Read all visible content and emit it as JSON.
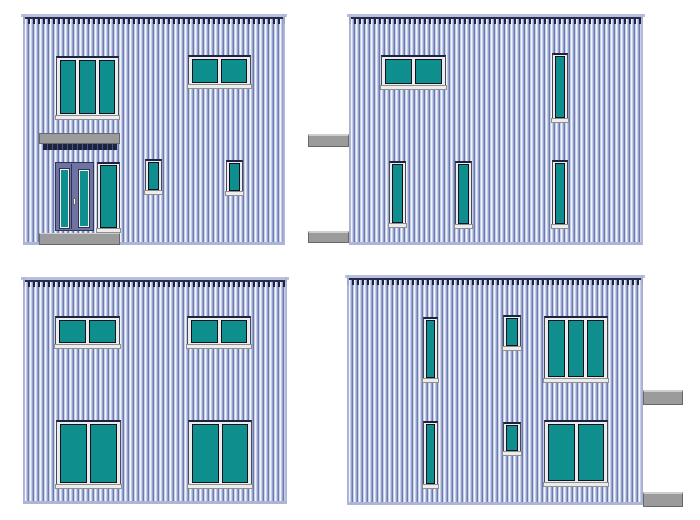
{
  "canvas": {
    "width": 700,
    "height": 520,
    "background": "#ffffff"
  },
  "colors": {
    "siding_dark": "#6e7cab",
    "siding_light": "#c7cfe8",
    "siding_white": "#f2f5fb",
    "siding_mid": "#96a2d0",
    "glass": "#0e8f8e",
    "pane_edge": "#0c1020",
    "frame": "#ececec",
    "frame_edge": "#474a55",
    "sill_edge": "#8f8f8f",
    "head_dark": "#1c2240",
    "gray": "#9b9b9b",
    "gray_edge": "#686868",
    "gray_highlight": "#cfcfcf",
    "door": "#6e73a2",
    "door_edge": "#2f3454",
    "roof_light": "#b9c0de",
    "roof_dark": "#272c4e",
    "edge_light": "#aeb6d8",
    "canopy_shadow_alt": "#4a5584"
  },
  "elevations": [
    {
      "id": "front",
      "x": 23,
      "y": 14,
      "w": 262,
      "h": 231,
      "windows": [
        {
          "type": "h3",
          "x": 33,
          "y": 42,
          "w": 63,
          "h": 63,
          "panes": 3
        },
        {
          "type": "h2",
          "x": 165,
          "y": 41,
          "w": 63,
          "h": 33,
          "panes": 2
        },
        {
          "type": "v",
          "x": 74,
          "y": 148,
          "w": 23,
          "h": 70,
          "panes": 1
        },
        {
          "type": "s",
          "x": 122,
          "y": 145,
          "w": 17,
          "h": 35,
          "panes": 1
        },
        {
          "type": "s",
          "x": 203,
          "y": 146,
          "w": 17,
          "h": 35,
          "panes": 1
        }
      ],
      "canopy": {
        "x": 16,
        "y": 119,
        "w": 81,
        "h": 11,
        "shadow": {
          "x": 20,
          "y": 130,
          "w": 74,
          "h": 6
        }
      },
      "door": {
        "x": 32,
        "y": 148,
        "w": 39,
        "h": 69,
        "lites": [
          {
            "x": 4,
            "y": 6,
            "w": 7,
            "h": 57
          },
          {
            "x": 23,
            "y": 7,
            "w": 8,
            "h": 55
          }
        ],
        "divider_x": 15,
        "handle": {
          "x": 17,
          "y": 35,
          "w": 3,
          "h": 7
        }
      },
      "step": {
        "x": 16,
        "y": 219,
        "w": 81,
        "h": 12
      },
      "tabs": []
    },
    {
      "id": "side-a",
      "x": 349,
      "y": 14,
      "w": 294,
      "h": 231,
      "windows": [
        {
          "type": "h2",
          "x": 32,
          "y": 41,
          "w": 65,
          "h": 34,
          "panes": 2
        },
        {
          "type": "v",
          "x": 203,
          "y": 39,
          "w": 16,
          "h": 69,
          "panes": 1
        },
        {
          "type": "v",
          "x": 40,
          "y": 147,
          "w": 17,
          "h": 66,
          "panes": 1
        },
        {
          "type": "v",
          "x": 106,
          "y": 147,
          "w": 17,
          "h": 67,
          "panes": 1
        },
        {
          "type": "v",
          "x": 203,
          "y": 146,
          "w": 16,
          "h": 68,
          "panes": 1
        }
      ],
      "tabs": [
        {
          "x": -41,
          "y": 120,
          "w": 41,
          "h": 13
        },
        {
          "x": -41,
          "y": 217,
          "w": 41,
          "h": 12
        }
      ]
    },
    {
      "id": "rear",
      "x": 23,
      "y": 277,
      "w": 264,
      "h": 227,
      "windows": [
        {
          "type": "h2",
          "x": 32,
          "y": 39,
          "w": 65,
          "h": 32,
          "panes": 2
        },
        {
          "type": "h2",
          "x": 164,
          "y": 39,
          "w": 64,
          "h": 32,
          "panes": 2
        },
        {
          "type": "h2",
          "x": 33,
          "y": 143,
          "w": 65,
          "h": 68,
          "panes": 2
        },
        {
          "type": "h2",
          "x": 165,
          "y": 143,
          "w": 64,
          "h": 68,
          "panes": 2
        }
      ],
      "tabs": []
    },
    {
      "id": "side-b",
      "x": 347,
      "y": 275,
      "w": 296,
      "h": 230,
      "windows": [
        {
          "type": "v",
          "x": 76,
          "y": 42,
          "w": 15,
          "h": 65,
          "panes": 1
        },
        {
          "type": "s",
          "x": 156,
          "y": 40,
          "w": 18,
          "h": 35,
          "panes": 1
        },
        {
          "type": "h3",
          "x": 197,
          "y": 41,
          "w": 64,
          "h": 66,
          "panes": 3
        },
        {
          "type": "v",
          "x": 76,
          "y": 146,
          "w": 15,
          "h": 67,
          "panes": 1
        },
        {
          "type": "s",
          "x": 156,
          "y": 147,
          "w": 18,
          "h": 33,
          "panes": 1
        },
        {
          "type": "h2",
          "x": 197,
          "y": 145,
          "w": 64,
          "h": 66,
          "panes": 2
        }
      ],
      "tabs": [
        {
          "x": 296,
          "y": 115,
          "w": 40,
          "h": 15
        },
        {
          "x": 296,
          "y": 217,
          "w": 40,
          "h": 15
        }
      ]
    }
  ]
}
